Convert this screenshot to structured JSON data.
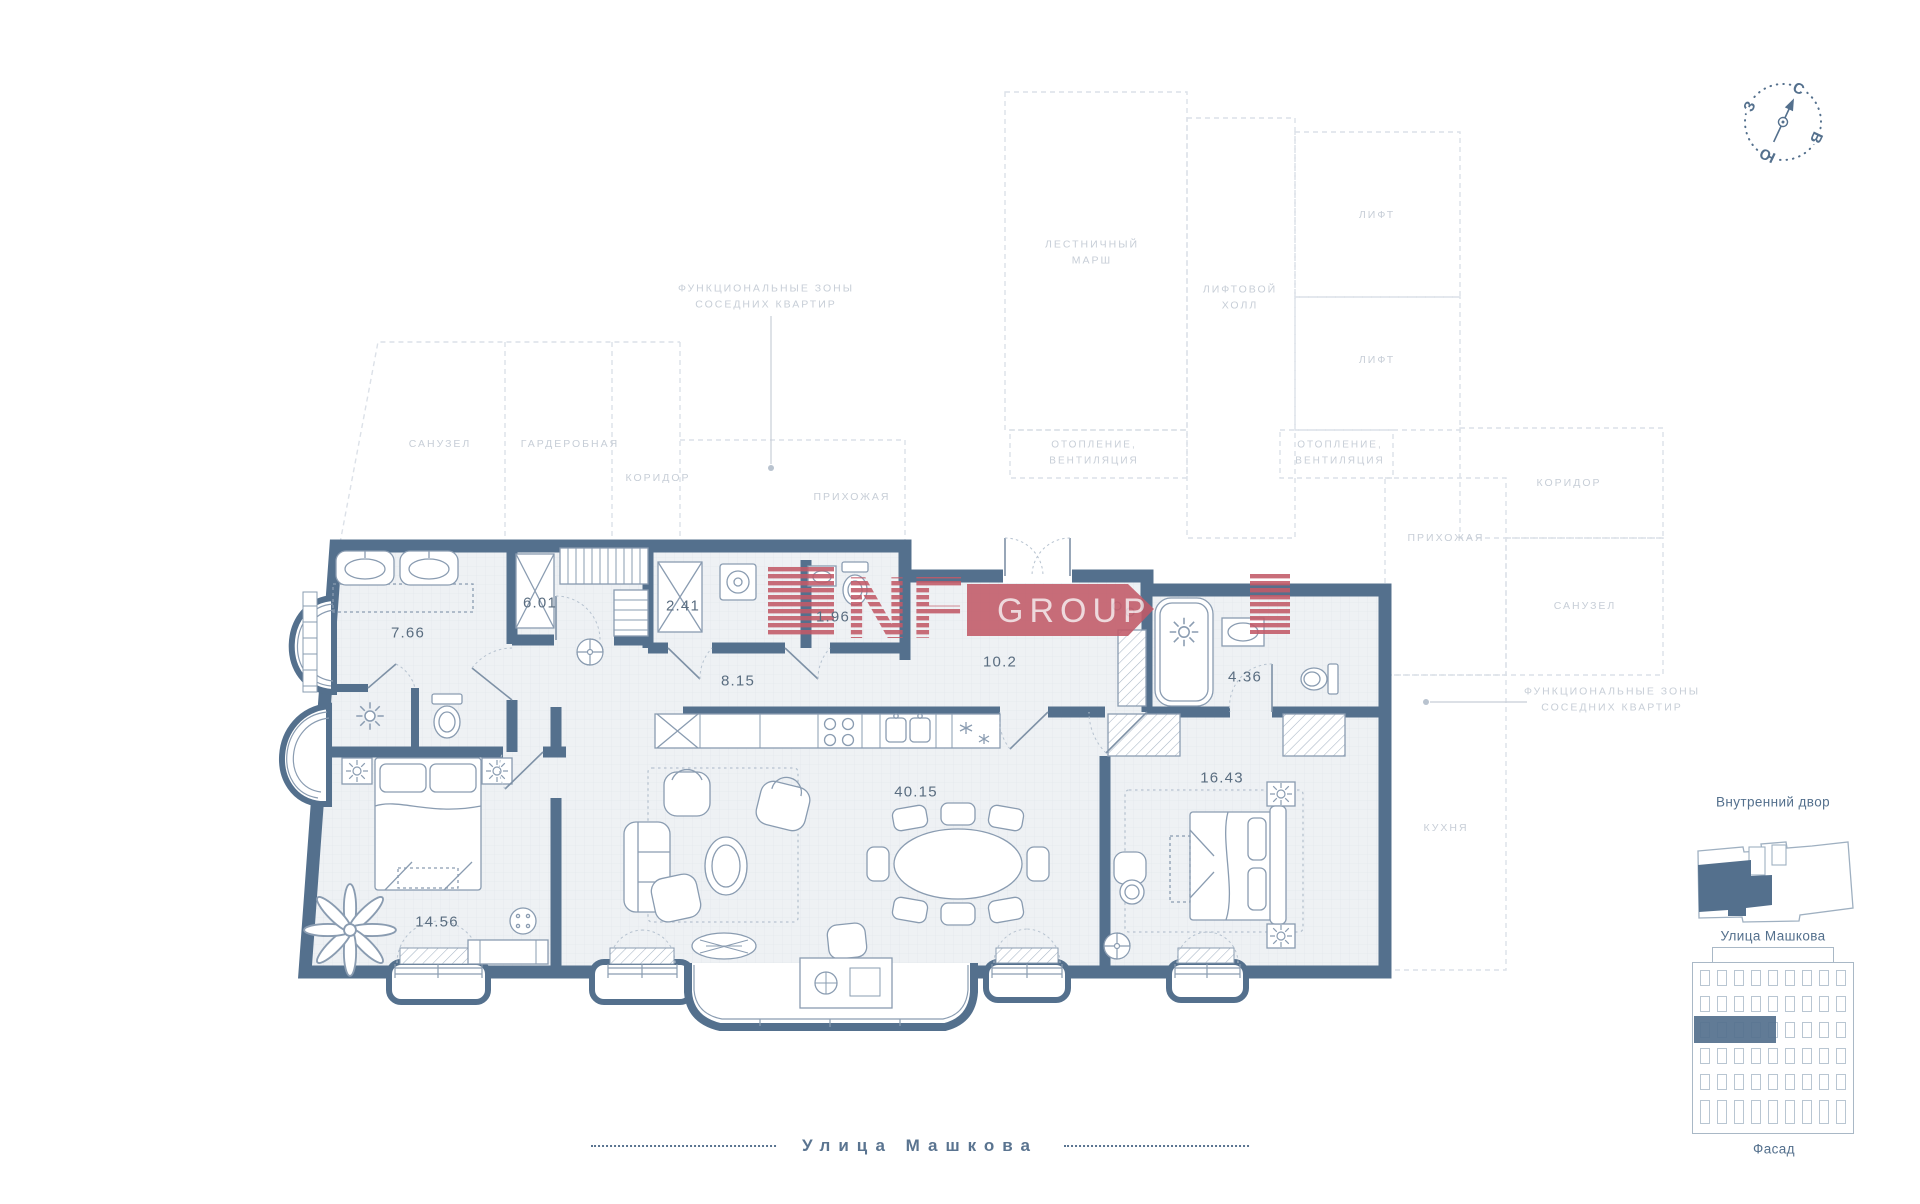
{
  "colors": {
    "wall": "#54708d",
    "floor": "#eef1f4",
    "furniture": "#8a9cb1",
    "zone_line": "#dce1e8",
    "zone_text": "#c7ced7",
    "number_text": "#5a6d80",
    "logo_red": "#c25a68",
    "logo_text": "#eed6d9"
  },
  "compass": {
    "n": "С",
    "e": "В",
    "s": "Ю",
    "w": "З"
  },
  "logo": {
    "nf": "NF",
    "group": "GROUP"
  },
  "zones": {
    "stair": "ЛЕСТНИЧНЫЙ\nМАРШ",
    "lift_hall": "ЛИФТОВОЙ\nХОЛЛ",
    "lift_1": "ЛИФТ",
    "lift_2": "ЛИФТ",
    "heating_1": "ОТОПЛЕНИЕ,\nВЕНТИЛЯЦИЯ",
    "heating_2": "ОТОПЛЕНИЕ,\nВЕНТИЛЯЦИЯ",
    "corridor_right": "КОРИДОР",
    "hallway_right": "ПРИХОЖАЯ",
    "bathroom_right": "САНУЗЕЛ",
    "kitchen_right": "КУХНЯ",
    "bathroom_left": "САНУЗЕЛ",
    "wardrobe_left": "ГАРДЕРОБНАЯ",
    "corridor_left": "КОРИДОР",
    "hallway_left": "ПРИХОЖАЯ"
  },
  "callouts": {
    "neighbor_left": "ФУНКЦИОНАЛЬНЫЕ ЗОНЫ\nСОСЕДНИХ КВАРТИР",
    "neighbor_right": "ФУНКЦИОНАЛЬНЫЕ ЗОНЫ\nСОСЕДНИХ КВАРТИР"
  },
  "rooms": {
    "bathroom_main": "7.66",
    "wardrobe": "6.01",
    "utility": "2.41",
    "wc": "1.96",
    "corridor": "8.15",
    "hallway": "10.2",
    "bathroom_second": "4.36",
    "living_kitchen": "40.15",
    "bedroom_second": "16.43",
    "bedroom_main": "14.56"
  },
  "street": {
    "name": "Улица Машкова"
  },
  "minimap": {
    "courtyard": "Внутренний двор",
    "street": "Улица Машкова",
    "facade": "Фасад"
  }
}
